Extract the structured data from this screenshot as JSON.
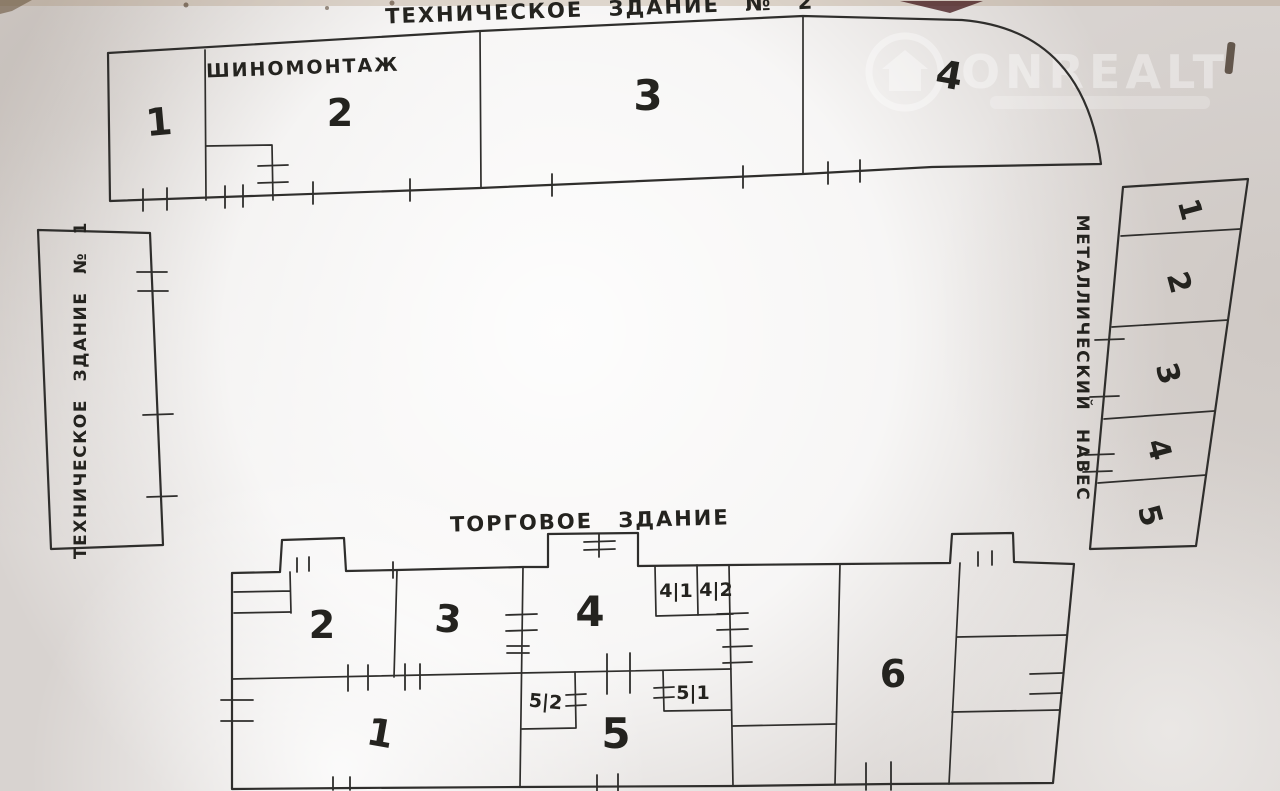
{
  "palette": {
    "paper": "#d8d3d0",
    "paper_bright": "#fbfafa",
    "ink": "#2f2e2c"
  },
  "watermark": {
    "brand": "ONREALT"
  },
  "tech_building_2": {
    "title": "ТЕХНИЧЕСКОЕ ЗДАНИЕ № 2",
    "tire_service_label": "ШИНОМОНТАЖ",
    "rooms": {
      "r1": "1",
      "r2": "2",
      "r3": "3",
      "r4": "4"
    }
  },
  "tech_building_1": {
    "title": "ТЕХНИЧЕСКОЕ ЗДАНИЕ № 1"
  },
  "metal_canopy": {
    "title": "МЕТАЛЛИЧЕСКИЙ НАВЕС",
    "sections": {
      "s1": "1",
      "s2": "2",
      "s3": "3",
      "s4": "4",
      "s5": "5"
    }
  },
  "trade_building": {
    "title": "ТОРГОВОЕ ЗДАНИЕ",
    "rooms": {
      "r1": "1",
      "r2": "2",
      "r3": "3",
      "r4": "4",
      "r4_1": "4|1",
      "r4_2": "4|2",
      "r5": "5",
      "r5_1": "5|1",
      "r5_2": "5|2",
      "r6": "6"
    }
  }
}
